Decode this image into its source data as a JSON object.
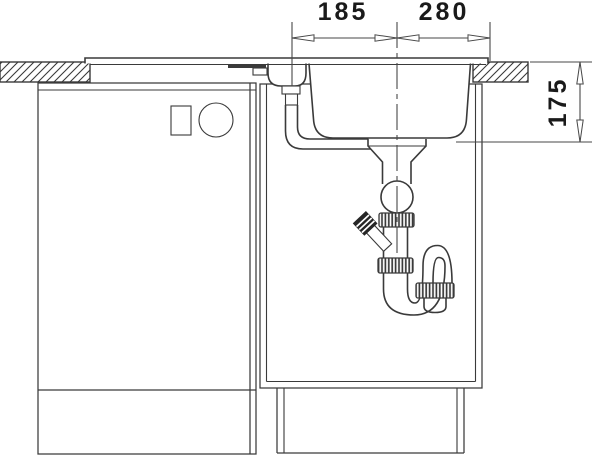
{
  "dimension_labels": {
    "top_left": "185",
    "top_right": "280",
    "right_vertical": "175"
  },
  "colors": {
    "line": "#3a3a3a",
    "dim": "#474747",
    "text": "#1a1a1a",
    "cap": "#262626",
    "background": "#ffffff"
  }
}
